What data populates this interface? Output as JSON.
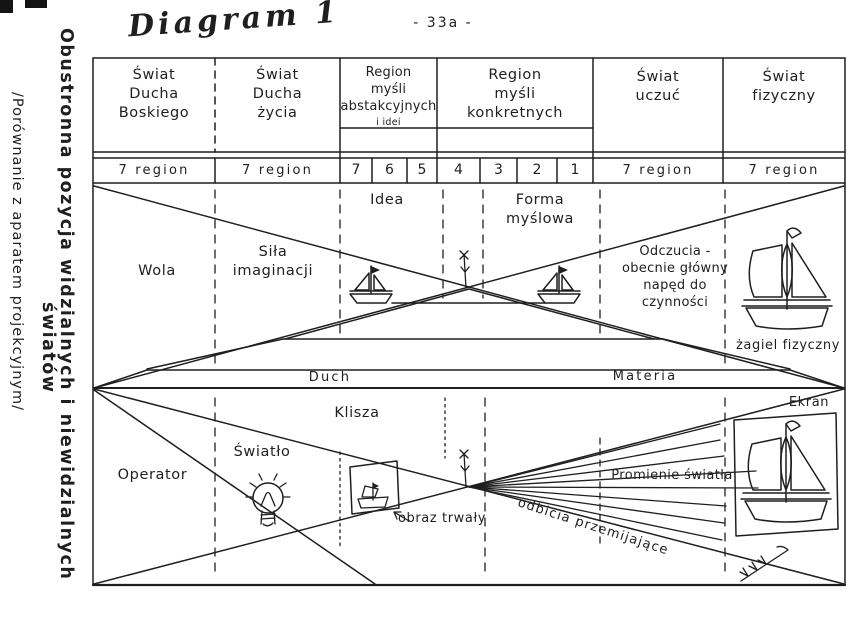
{
  "page": {
    "title": "Diagram 1",
    "page_number": "- 33a -",
    "ink_color": "#1f1f1f",
    "paper_color": "#ffffff"
  },
  "side_title": {
    "line1": "Obustronna pozycja widzialnych i niewidzialnych",
    "line2": "światów",
    "subtitle": "/Porównanie z aparatem projekcyjnym/"
  },
  "table": {
    "header": [
      {
        "label": "Świat\nDucha\nBoskiego"
      },
      {
        "label": "Świat\nDucha\nżycia"
      },
      {
        "label": "Region\nmyśli\nabstakcyjnych",
        "sublabel": "i idei"
      },
      {
        "label": "Region\nmyśli\nkonkretnych"
      },
      {
        "label": "Świat\nuczuć"
      },
      {
        "label": "Świat\nfizyczny"
      }
    ],
    "region_row": [
      "7 region",
      "7 region",
      "7",
      "6",
      "5",
      "4",
      "3",
      "2",
      "1",
      "7 region",
      "7 region"
    ]
  },
  "upper_half": {
    "wola": "Wola",
    "sila_imaginacji": "Siła\nimaginacji",
    "idea": "Idea",
    "forma_myslowa": "Forma\nmyślowa",
    "odczucia": "Odczucia -\nobecnie główny\nnapęd do czynności",
    "zagiel_fizyczny": "żagiel fizyczny"
  },
  "axis_band": {
    "duch": "Duch",
    "materia": "Materia"
  },
  "lower_half": {
    "operator": "Operator",
    "swiatlo": "Światło",
    "klisza": "Klisza",
    "obraz_trwaly": "obraz trwały",
    "promienie_swiatla": "Promienie światła",
    "odbicia_przemijajace": "odbicia przemijające",
    "ekran": "Ekran"
  }
}
